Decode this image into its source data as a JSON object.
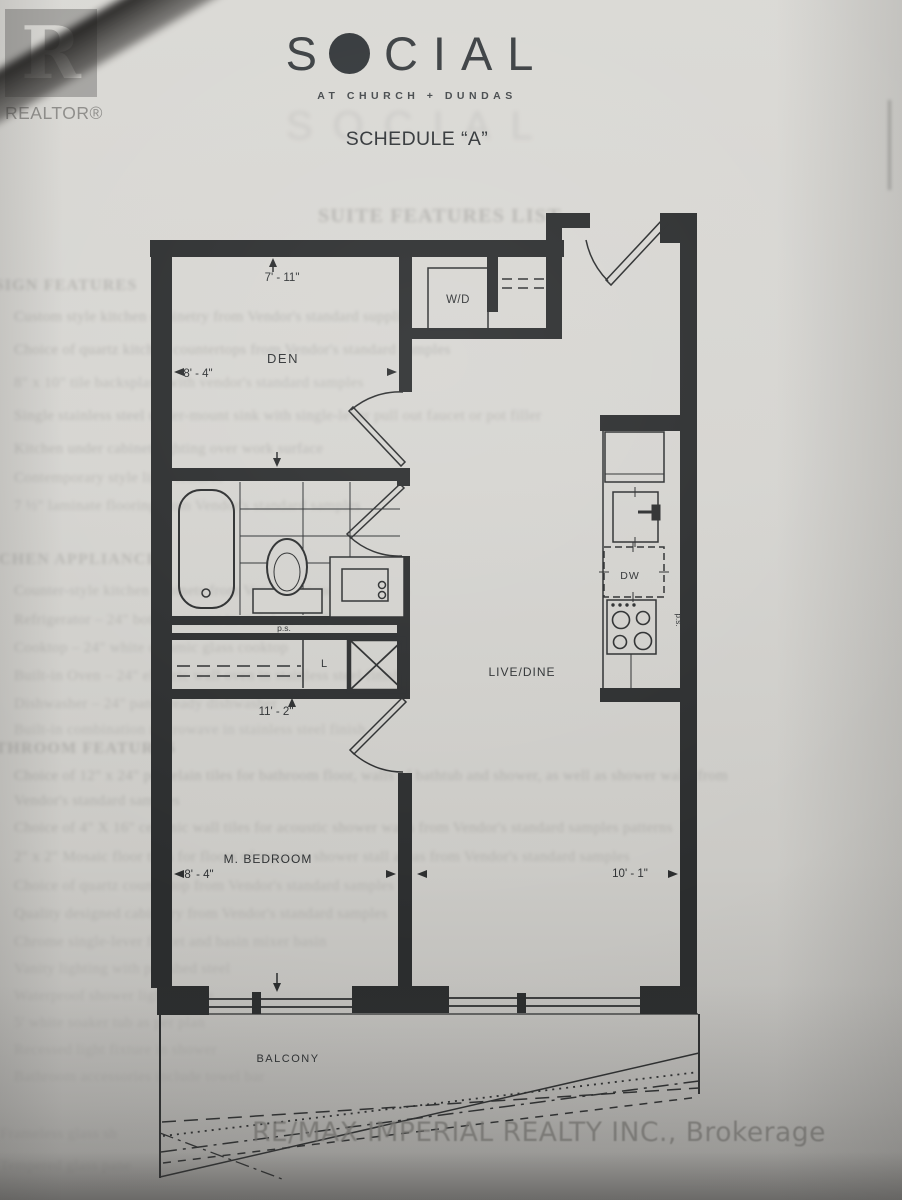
{
  "header": {
    "realtor": {
      "initial": "R",
      "label": "REALTOR®"
    },
    "social": {
      "first": "S",
      "rest": "CIAL",
      "tagline": "AT CHURCH + DUNDAS",
      "ghost": "SOCIAL",
      "schedule": "SCHEDULE “A”"
    }
  },
  "plan": {
    "rooms": {
      "den": "DEN",
      "wd": "W/D",
      "live": "LIVE/DINE",
      "bedroom": "M. BEDROOM",
      "balcony": "BALCONY",
      "dw": "DW",
      "linen": "L",
      "ps_bath": "p.s.",
      "ps_kitchen": "p.s."
    },
    "dims": {
      "den_h": "7' - 11\"",
      "den_w": "8' - 4\"",
      "hall_w": "11' - 2\"",
      "bed_w": "8' - 4\"",
      "live_w": "10' - 1\""
    }
  },
  "ghost": {
    "lines": [
      {
        "x": 318,
        "y": 205,
        "s": 20,
        "o": 0.32,
        "b": 1,
        "t": "SUITE FEATURES LIST"
      },
      {
        "x": -30,
        "y": 277,
        "s": 16,
        "o": 0.3,
        "b": 1,
        "t": "DESIGN FEATURES"
      },
      {
        "x": 14,
        "y": 309,
        "s": 15,
        "o": 0.3,
        "t": "Custom style kitchen cabinetry from Vendor's standard suppli"
      },
      {
        "x": 14,
        "y": 342,
        "s": 15,
        "o": 0.3,
        "t": "Choice of quartz kitchen countertops from Vendor's standard samples"
      },
      {
        "x": 14,
        "y": 375,
        "s": 15,
        "o": 0.26,
        "t": "8\" x 10\" tile backsplash with vendor's standard samples"
      },
      {
        "x": 14,
        "y": 408,
        "s": 15,
        "o": 0.28,
        "t": "Single stainless steel under-mount sink with single-lever pull out faucet or pot filler"
      },
      {
        "x": 14,
        "y": 441,
        "s": 15,
        "o": 0.28,
        "t": "Kitchen under cabinet lighting over work surface"
      },
      {
        "x": 14,
        "y": 470,
        "s": 15,
        "o": 0.26,
        "t": "Contemporary style light fixtures"
      },
      {
        "x": 14,
        "y": 498,
        "s": 15,
        "o": 0.26,
        "t": "7 ½\" laminate flooring from Vendor's standard samples"
      },
      {
        "x": -34,
        "y": 551,
        "s": 16,
        "o": 0.26,
        "b": 1,
        "t": "KITCHEN APPLIANCES"
      },
      {
        "x": 14,
        "y": 583,
        "s": 15,
        "o": 0.26,
        "t": "Counter-style kitchen cabinets from Vendor's standard samples"
      },
      {
        "x": 14,
        "y": 612,
        "s": 15,
        "o": 0.26,
        "t": "Refrigerator – 24\" bottom mount in stainless steel finish"
      },
      {
        "x": 14,
        "y": 640,
        "s": 15,
        "o": 0.24,
        "t": "Cooktop – 24\" white ceramic glass cooktop"
      },
      {
        "x": 14,
        "y": 668,
        "s": 15,
        "o": 0.24,
        "t": "Built-in Oven – 24\" electric wall oven in stainless steel finish"
      },
      {
        "x": 14,
        "y": 696,
        "s": 15,
        "o": 0.24,
        "t": "Dishwasher – 24\" panel ready dishwasher"
      },
      {
        "x": 14,
        "y": 722,
        "s": 15,
        "o": 0.22,
        "t": "Built-in combination microwave in stainless steel finish"
      },
      {
        "x": -28,
        "y": 740,
        "s": 16,
        "o": 0.3,
        "b": 1,
        "t": "BATHROOM FEATURES"
      },
      {
        "x": 14,
        "y": 768,
        "s": 15,
        "o": 0.3,
        "t": "Choice of 12\" x 24\" porcelain tiles for bathroom floor, walls of bathtub and shower, as well as shower walls from"
      },
      {
        "x": 14,
        "y": 793,
        "s": 15,
        "o": 0.28,
        "t": "Vendor's standard samples"
      },
      {
        "x": 14,
        "y": 820,
        "s": 15,
        "o": 0.28,
        "t": "Choice of 4\" X 16\" ceramic wall tiles for acoustic shower walls from Vendor's standard samples patterns"
      },
      {
        "x": 14,
        "y": 849,
        "s": 15,
        "o": 0.26,
        "t": "2\" x 2\" Mosaic floor tiles for floors of separate shower stall areas from Vendor's standard samples"
      },
      {
        "x": 14,
        "y": 878,
        "s": 15,
        "o": 0.24,
        "t": "Choice of quartz countertop from Vendor's standard samples"
      },
      {
        "x": 14,
        "y": 906,
        "s": 15,
        "o": 0.24,
        "t": "Quality designed cabinetry from Vendor's standard samples"
      },
      {
        "x": 14,
        "y": 934,
        "s": 15,
        "o": 0.22,
        "t": "Chrome single-lever faucet and basin mixer basin"
      },
      {
        "x": 14,
        "y": 961,
        "s": 15,
        "o": 0.2,
        "t": "Vanity lighting with polished steel"
      },
      {
        "x": 14,
        "y": 988,
        "s": 15,
        "o": 0.18,
        "t": "Waterproof shower light fixture"
      },
      {
        "x": 14,
        "y": 1015,
        "s": 15,
        "o": 0.18,
        "t": "5' white soaker tub as per plan"
      },
      {
        "x": 14,
        "y": 1042,
        "s": 15,
        "o": 0.16,
        "t": "Recessed light fixture in shower"
      },
      {
        "x": 14,
        "y": 1069,
        "s": 15,
        "o": 0.16,
        "t": "Bathroom accessories include towel bar"
      },
      {
        "x": 0,
        "y": 1126,
        "s": 15,
        "o": 0.18,
        "t": "Frameless glass sh"
      },
      {
        "x": 0,
        "y": 1158,
        "s": 15,
        "o": 0.18,
        "t": "Tempered glass pane"
      }
    ]
  },
  "watermark": "RE/MAX IMPERIAL REALTY INC., Brokerage",
  "colors": {
    "ink": "#2b2d2e",
    "paper": "#d4d3cf",
    "logo_gray": "#a5a4a1",
    "watermark_gray": "#8f8e8b"
  }
}
